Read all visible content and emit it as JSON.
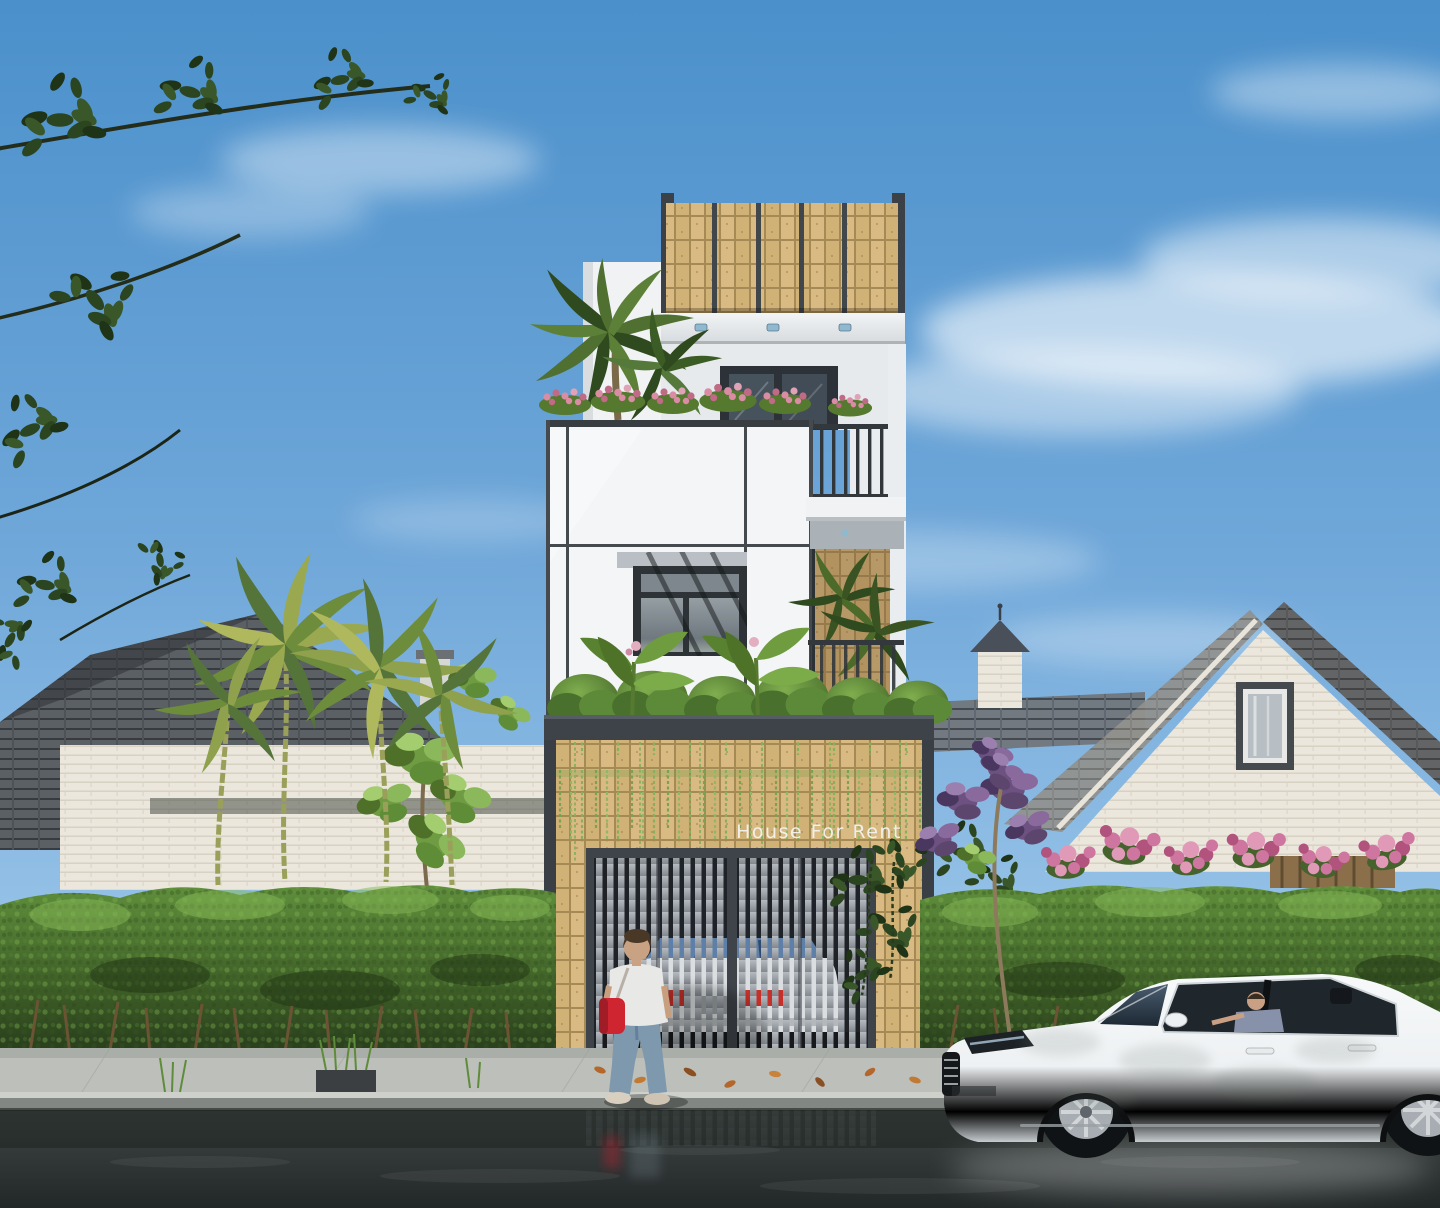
{
  "scene": {
    "sign_text": "House For Rent",
    "colors": {
      "sky_top": "#4b90cb",
      "sky_bottom": "#b8d7ee",
      "stone_brick": "#d8ba82",
      "brick_grout": "#a68a55",
      "dark_frame": "#3f444a",
      "white_wall": "#f3f5f6",
      "gate_slat": "#a9afb4",
      "gate_interior": "#1f2327",
      "hedge_green": "#4f7c31",
      "palm_frond": "#9aa850",
      "flower_pink": "#cf76a0",
      "flower_purple": "#6d5180",
      "rooftop_flower_pink": "#d98ca4",
      "roof_tile_gray": "#71767b",
      "white_brick_house": "#ebe7dd",
      "street_car_white": "#f2f4f5",
      "taillight_red": "#c5302a",
      "bag_red": "#cf2531",
      "sidewalk_gray": "#bcbfba",
      "road_asphalt": "#2b3131"
    }
  }
}
